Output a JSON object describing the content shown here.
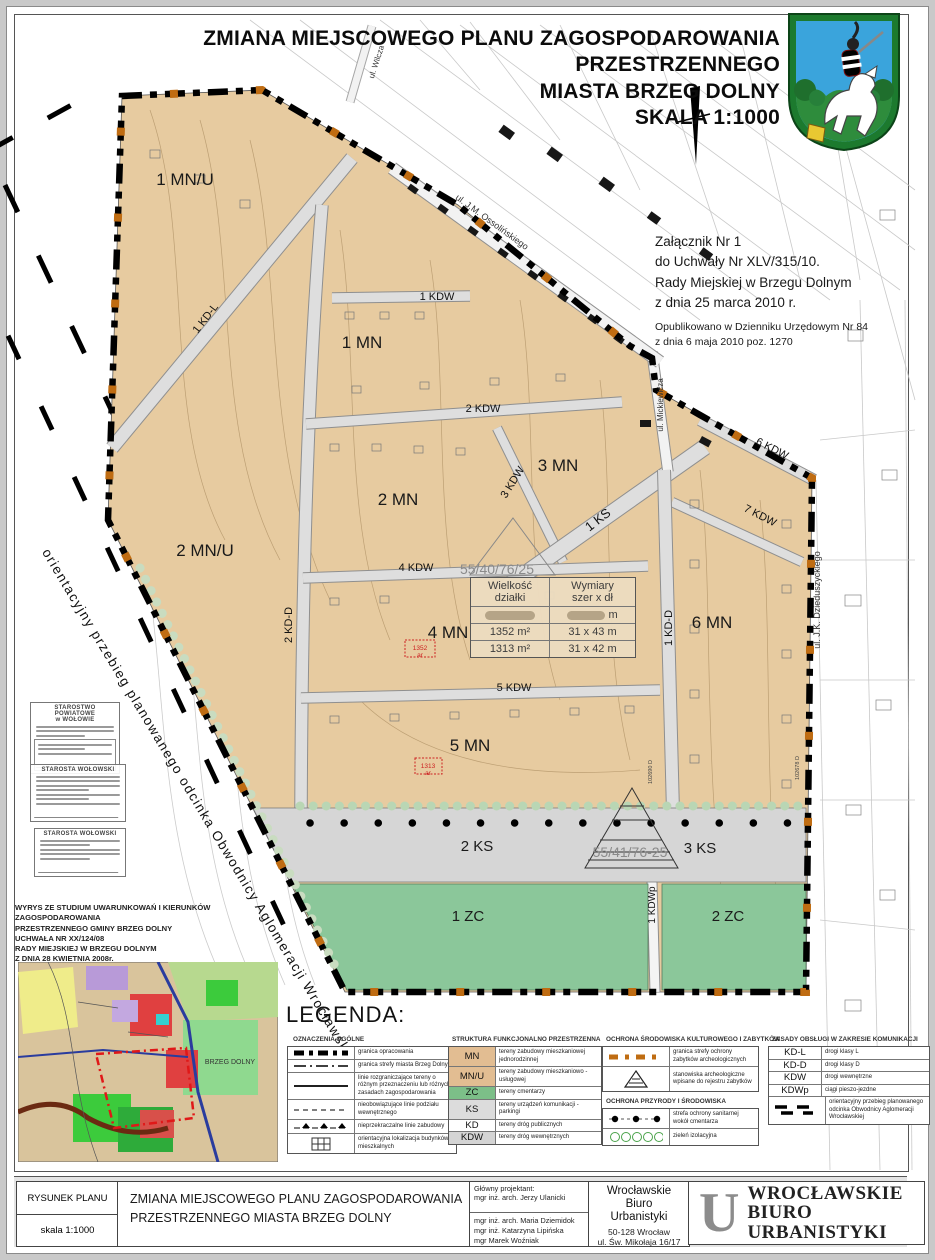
{
  "header": {
    "title_line1": "ZMIANA MIEJSCOWEGO PLANU  ZAGOSPODAROWANIA PRZESTRZENNEGO",
    "title_line2": "MIASTA BRZEG DOLNY",
    "title_line3": "SKALA 1:1000"
  },
  "annex": {
    "line1": "Załącznik Nr 1",
    "line2": "do Uchwały  Nr  XLV/315/10.",
    "line3": "Rady Miejskiej w Brzegu Dolnym",
    "line4": "z dnia 25  marca 2010 r.",
    "pub1": "Opublikowano w Dzienniku Urzędowym Nr 84",
    "pub2": "z dnia 6 maja 2010 poz. 1270"
  },
  "map": {
    "zones": {
      "mnu1": "1 MN/U",
      "mnu2": "2 MN/U",
      "mn1": "1 MN",
      "mn2": "2 MN",
      "mn3": "3 MN",
      "mn4": "4 MN",
      "mn5": "5 MN",
      "mn6": "6 MN",
      "ks1": "1 KS",
      "ks2": "2 KS",
      "ks3": "3 KS",
      "zc1": "1 ZC",
      "zc2": "2 ZC"
    },
    "roads": {
      "kdl1": "1 KD-L",
      "kdd2": "2 KD-D",
      "kdd1": "1 KD-D",
      "kdw1": "1 KDW",
      "kdw2": "2 KDW",
      "kdw3": "3 KDW",
      "kdw4": "4 KDW",
      "kdw5": "5 KDW",
      "kdw6": "6 KDW",
      "kdw7": "7 KDW",
      "kdwp1": "1 KDWp"
    },
    "streets": {
      "wilcza": "ul. Wilcza",
      "ossolinskiego": "ul. J.M. Ossolińskiego",
      "mickiewicza": "ul. Mickiewicza",
      "chopina": "ul. Chopina",
      "dzieduszyckiego": "ul. J.K. Dzieduszyckiego"
    },
    "parcel_refs": {
      "a": "55/40/76/25",
      "b": "55/41/76-25"
    },
    "point_refs": {
      "a": "102690 D",
      "b": "102678 D"
    },
    "red_marks": {
      "a1": "1352",
      "a2": "ar",
      "b1": "1313",
      "b2": "ar"
    },
    "bypass_note": "orientacyjny przebieg planowanego odcinka Obwodnicy Aglomeracji Wrocławskiej"
  },
  "table": {
    "h1a": "Wielkość",
    "h1b": "działki",
    "h2a": "Wymiary",
    "h2b": "szer x dł",
    "row0_unit": "m",
    "rows": [
      {
        "size": "1352 m²",
        "dims": "31 x 43 m"
      },
      {
        "size": "1313 m²",
        "dims": "31 x 42 m"
      }
    ]
  },
  "stamps": {
    "s1a": "STAROSTWO POWIATOWE",
    "s1b": "w WOŁOWIE",
    "s2": "STAROSTA  WOŁOWSKI",
    "s3": "STAROSTA  WOŁOWSKI"
  },
  "study_note": {
    "l1": "WYRYS ZE STUDIUM UWARUNKOWAŃ I KIERUNKÓW ZAGOSPODAROWANIA",
    "l2": "PRZESTRZENNEGO GMINY BRZEG DOLNY",
    "l3": "UCHWAŁA NR XX/124/08",
    "l4": "RADY MIEJSKIEJ W BRZEGU DOLNYM",
    "l5": "Z DNIA 28 KWIETNIA 2008r.",
    "city_label": "BRZEG DOLNY"
  },
  "legend": {
    "title": "LEGENDA:",
    "sec1": {
      "heading": "OZNACZENIA OGÓLNE",
      "items": [
        "granica opracowania",
        "granica strefy miasta Brzeg Dolny",
        "linie rozgraniczające tereny o różnym przeznaczeniu lub różnych zasadach zagospodarowania",
        "nieobowiązujące linie podziału wewnętrznego",
        "nieprzekraczalne linie zabudowy",
        "orientacyjna lokalizacja budynków mieszkalnych"
      ]
    },
    "sec2": {
      "heading": "STRUKTURA FUNKCJONALNO PRZESTRZENNA",
      "items": [
        {
          "code": "MN",
          "desc": "tereny zabudowy mieszkaniowej jednorodzinnej"
        },
        {
          "code": "MN/U",
          "desc": "tereny zabudowy mieszkaniowo - usługowej"
        },
        {
          "code": "ZC",
          "desc": "tereny cmentarzy"
        },
        {
          "code": "KS",
          "desc": "tereny urządzeń komunikacji - parkingi"
        },
        {
          "code": "KD",
          "desc": "tereny dróg publicznych"
        },
        {
          "code": "KDW",
          "desc": "tereny dróg wewnętrznych"
        }
      ]
    },
    "sec3": {
      "heading": "OCHRONA ŚRODOWISKA KULTUROWEGO I ZABYTKÓW",
      "items": [
        "granica strefy ochrony zabytków archeologicznych",
        "stanowiska archeologiczne wpisane do rejestru zabytków"
      ]
    },
    "sec4": {
      "heading": "OCHRONA PRZYRODY I ŚRODOWISKA",
      "items": [
        "strefa ochrony sanitarnej wokół cmentarza",
        "zieleń izolacyjna"
      ]
    },
    "sec5": {
      "heading": "ZASADY OBSŁUGI W ZAKRESIE KOMUNIKACJI",
      "items": [
        {
          "code": "KD-L",
          "desc": "drogi klasy L"
        },
        {
          "code": "KD-D",
          "desc": "drogi klasy D"
        },
        {
          "code": "KDW",
          "desc": "drogi wewnętrzne"
        },
        {
          "code": "KDWp",
          "desc": "ciągi pieszo-jezdne"
        },
        {
          "code": "",
          "desc": "orientacyjny przebieg planowanego odcinka Obwodnicy Aglomeracji Wrocławskiej"
        }
      ]
    }
  },
  "footer": {
    "cell1_top": "RYSUNEK PLANU",
    "cell1_bottom": "skala 1:1000",
    "title_l1": "ZMIANA MIEJSCOWEGO PLANU ZAGOSPODAROWANIA",
    "title_l2": "PRZESTRZENNEGO MIASTA BRZEG DOLNY",
    "designer_label": "Główny projektant:",
    "designer": "mgr inż. arch. Jerzy Ulanicki",
    "team1": "mgr inż. arch. Maria Dziemidok",
    "team2": "mgr inż. Katarzyna Lipińska",
    "team3": "mgr Marek Woźniak",
    "office1": "Wrocławskie",
    "office2": "Biuro",
    "office3": "Urbanistyki",
    "office_addr1": "50-128 Wrocław",
    "office_addr2": "ul. Św. Mikołaja 16/17",
    "logo_letter": "U",
    "logo_l1": "WROCŁAWSKIE",
    "logo_l2": "BIURO",
    "logo_l3": "URBANISTYKI"
  },
  "colors": {
    "zone_tan": "#e7cba0",
    "zone_green": "#8bc79a",
    "road_grey": "#dedede",
    "ks_grey": "#d6d6d6",
    "boundary_black": "#000000",
    "archeo_orange": "#bf6c12",
    "red_mark": "#cc2222",
    "crest_green": "#1c7a2e",
    "crest_blue": "#3aa4dc"
  }
}
